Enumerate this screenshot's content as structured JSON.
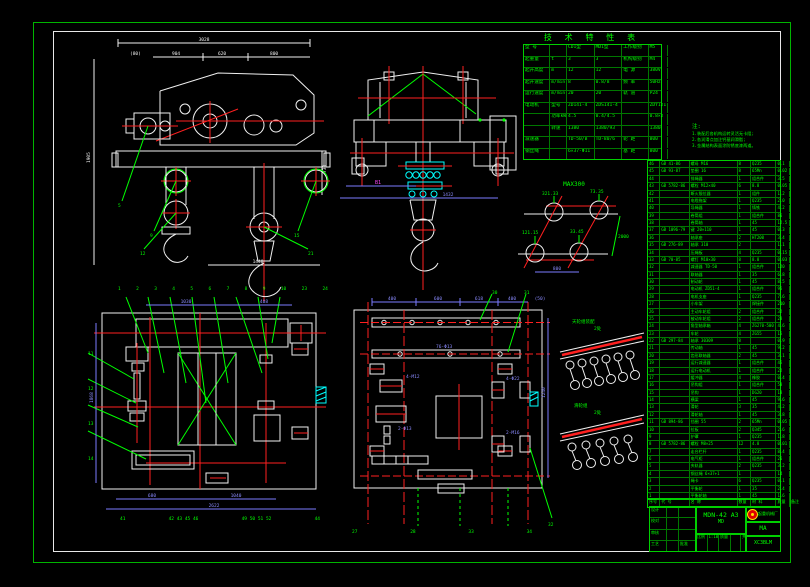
{
  "colors": {
    "green": "#00ff00",
    "red": "#ff2020",
    "white": "#f0f0f0",
    "cyan": "#00ffff",
    "blue": "#7b7bff",
    "magenta": "#ff46ff",
    "yellow": "#ffe000",
    "border": "#00b400"
  },
  "spec_table": {
    "title": "技 术 特 性 表",
    "rows": [
      [
        "型  号",
        "",
        "CD1型",
        "MD1型",
        "工作级别",
        "M5",
        ""
      ],
      [
        "起重量",
        "t",
        "3",
        "3",
        "机构级别",
        "M4",
        ""
      ],
      [
        "起升高度",
        "m",
        "12",
        "12",
        "电  源",
        "380V",
        ""
      ],
      [
        "起升速度",
        "m/min",
        "8",
        "0.8/8",
        "频  率",
        "50Hz",
        ""
      ],
      [
        "运行速度",
        "m/min",
        "20",
        "20",
        "轨  道",
        "P24",
        ""
      ],
      [
        "电动机",
        "型号",
        "ZD141-4",
        "ZDS141-4",
        "",
        "ZDY121-4",
        ""
      ],
      [
        "",
        "功率kW",
        "4.5",
        "0.4/4.5",
        "",
        "0.8×2",
        ""
      ],
      [
        "",
        "转速",
        "1380",
        "1380/93",
        "",
        "1380",
        ""
      ],
      [
        "减速器",
        "",
        "TD-50/B",
        "TD-80/6",
        "轮 距",
        "800",
        ""
      ],
      [
        "钢丝绳",
        "",
        "6×37-Φ11",
        "",
        "基 距",
        "800",
        ""
      ]
    ]
  },
  "notes": {
    "title": "注:",
    "lines": [
      "1.装配后各机构运转灵活无卡阻;",
      "2.各润滑点加注钙基润滑脂;",
      "3.金属结构表面涂防锈底漆两道。"
    ]
  },
  "wheel_diagram": {
    "title": "MAX300",
    "loads": [
      "321.33",
      "73.35",
      "121.15",
      "33.45"
    ],
    "span": "800",
    "side": "2000"
  },
  "details": {
    "upper": {
      "label": "天轮组装配",
      "qty": "2处"
    },
    "lower": {
      "label": "滑轮组",
      "qty": "2处"
    }
  },
  "views": {
    "A": {
      "dim_total": "3028",
      "dims": [
        "(80)",
        "904",
        "620",
        "800"
      ],
      "dim_left": "1905",
      "dim_right": "730",
      "dim_bottom": "1440",
      "leaders": [
        "5",
        "9",
        "12",
        "15",
        "21"
      ]
    },
    "B": {
      "dim1": "B1",
      "dim2": "1432"
    },
    "C": {
      "top_labels": [
        "1",
        "2",
        "3",
        "4",
        "5",
        "6",
        "7",
        "8",
        "9",
        "10",
        "23",
        "24"
      ],
      "left_labels": [
        "11",
        "12",
        "13",
        "14"
      ],
      "bottom_labels": [
        "41",
        "42 43 45 46",
        "49 50 51 52",
        "44"
      ],
      "dim_left": "1868",
      "dim_top1": "1030",
      "dim_top2": "408",
      "dim_b1": "680",
      "dim_b2": "1040",
      "dim_b3": "2622"
    },
    "D": {
      "top_dims": [
        "400",
        "600",
        "618",
        "400",
        "(50)"
      ],
      "dim_right": "1240",
      "labels": [
        "4-M12",
        "4-Φ22",
        "2-Φ13",
        "2-M16",
        "76-Φ13"
      ],
      "top_leaders": [
        "30",
        "31",
        "32"
      ],
      "bottom_labels": [
        "27",
        "28",
        "33",
        "34"
      ]
    }
  },
  "bom": {
    "footer": [
      "序号",
      "代  号",
      "名  称",
      "数量",
      "材 料",
      "质量",
      "备注"
    ],
    "rows": [
      [
        "46",
        "GB 41-86",
        "螺母 M16",
        "8",
        "Q235",
        "0.1",
        ""
      ],
      [
        "45",
        "GB 93-87",
        "垫圈 16",
        "8",
        "65Mn",
        "0.02",
        ""
      ],
      [
        "44",
        "",
        "排绳器",
        "1",
        "组合件",
        "3.5",
        ""
      ],
      [
        "43",
        "GB 5782-86",
        "螺栓 M12×40",
        "6",
        "8.8",
        "0.05",
        ""
      ],
      [
        "42",
        "",
        "断火限位器",
        "1",
        "组件",
        "1.2",
        ""
      ],
      [
        "41",
        "",
        "电缆拖架",
        "1",
        "Q235",
        "2.0",
        ""
      ],
      [
        "40",
        "",
        "导绳器",
        "1",
        "铸铁",
        "4.2",
        ""
      ],
      [
        "39",
        "",
        "卷筒组",
        "1",
        "组合件",
        "86",
        ""
      ],
      [
        "38",
        "",
        "卷筒轴",
        "1",
        "45",
        "12.5",
        ""
      ],
      [
        "37",
        "GB 1096-79",
        "键 20×110",
        "1",
        "45",
        "0.3",
        ""
      ],
      [
        "36",
        "",
        "轴承座",
        "2",
        "HT200",
        "3.4",
        ""
      ],
      [
        "35",
        "GB 276-89",
        "轴承 310",
        "2",
        "",
        "1.1",
        ""
      ],
      [
        "34",
        "",
        "压绳板",
        "4",
        "Q235",
        "0.15",
        ""
      ],
      [
        "33",
        "GB 70-85",
        "螺钉 M10×30",
        "8",
        "8.8",
        "0.03",
        ""
      ],
      [
        "32",
        "",
        "减速器 TD-50",
        "1",
        "组合件",
        "120",
        ""
      ],
      [
        "31",
        "",
        "联轴器",
        "1",
        "35",
        "6.8",
        ""
      ],
      [
        "30",
        "",
        "制动轮",
        "1",
        "45",
        "8.5",
        ""
      ],
      [
        "29",
        "",
        "电动机 ZD51-4",
        "1",
        "组合件",
        "95",
        ""
      ],
      [
        "28",
        "",
        "电机支座",
        "1",
        "Q235",
        "7.6",
        ""
      ],
      [
        "27",
        "",
        "小车架",
        "1",
        "焊接件",
        "210",
        ""
      ],
      [
        "26",
        "",
        "主动车轮组",
        "2",
        "组合件",
        "32",
        ""
      ],
      [
        "25",
        "",
        "被动车轮组",
        "2",
        "组合件",
        "28",
        ""
      ],
      [
        "24",
        "",
        "角型轴承箱",
        "4",
        "ZG270-500",
        "4.6",
        ""
      ],
      [
        "23",
        "",
        "车轮",
        "4",
        "ZG55",
        "15",
        ""
      ],
      [
        "22",
        "GB 297-84",
        "轴承 30309",
        "8",
        "",
        "0.9",
        ""
      ],
      [
        "21",
        "",
        "传动轴",
        "1",
        "45",
        "9.2",
        ""
      ],
      [
        "20",
        "",
        "齿形联轴器",
        "2",
        "45",
        "3.1",
        ""
      ],
      [
        "19",
        "",
        "运行减速器",
        "1",
        "组合件",
        "45",
        ""
      ],
      [
        "18",
        "",
        "运行电动机",
        "1",
        "组合件",
        "22",
        ""
      ],
      [
        "17",
        "",
        "缓冲器",
        "4",
        "橡胶",
        "0.4",
        ""
      ],
      [
        "16",
        "",
        "吊钩组",
        "1",
        "组合件",
        "58",
        ""
      ],
      [
        "15",
        "",
        "吊钩",
        "1",
        "DG20",
        "18",
        ""
      ],
      [
        "14",
        "",
        "横梁",
        "1",
        "45",
        "9.6",
        ""
      ],
      [
        "13",
        "",
        "滑轮",
        "3",
        "35",
        "4.2",
        ""
      ],
      [
        "12",
        "",
        "滑轮轴",
        "1",
        "45",
        "3.8",
        ""
      ],
      [
        "11",
        "GB 894-86",
        "挡圈 55",
        "2",
        "65Mn",
        "0.05",
        ""
      ],
      [
        "10",
        "",
        "拉板",
        "2",
        "Q345",
        "2.6",
        ""
      ],
      [
        "9",
        "",
        "护罩",
        "1",
        "Q235",
        "1.8",
        ""
      ],
      [
        "8",
        "GB 5782-86",
        "螺栓 M8×25",
        "12",
        "4.8",
        "0.01",
        ""
      ],
      [
        "7",
        "",
        "走台栏杆",
        "1",
        "Q235",
        "8.4",
        ""
      ],
      [
        "6",
        "",
        "电气柜",
        "1",
        "组合件",
        "26",
        ""
      ],
      [
        "5",
        "",
        "夹轨器",
        "2",
        "Q235",
        "3.2",
        ""
      ],
      [
        "4",
        "",
        "钢丝绳 6×37+1",
        "1",
        "",
        "14",
        ""
      ],
      [
        "3",
        "",
        "绳卡",
        "6",
        "Q235",
        "0.1",
        ""
      ],
      [
        "2",
        "",
        "平衡轮",
        "1",
        "35",
        "2.4",
        ""
      ],
      [
        "1",
        "",
        "平衡轮轴",
        "1",
        "45",
        "1.6",
        ""
      ]
    ]
  },
  "title_block": {
    "drawing_no": "MDN-42 A3",
    "drawing_no2": "MD",
    "company": "起重机械厂",
    "cert": "MA",
    "code": "XC3BLM",
    "sig_rows": [
      [
        "设计",
        "",
        "",
        ""
      ],
      [
        "校对",
        "",
        "",
        ""
      ],
      [
        "审核",
        "",
        "",
        ""
      ],
      [
        "工艺",
        "",
        "批准",
        ""
      ]
    ],
    "scale_row": [
      [
        "比例",
        "1:10",
        "质量",
        "",
        "共1张",
        "第1张"
      ]
    ]
  }
}
